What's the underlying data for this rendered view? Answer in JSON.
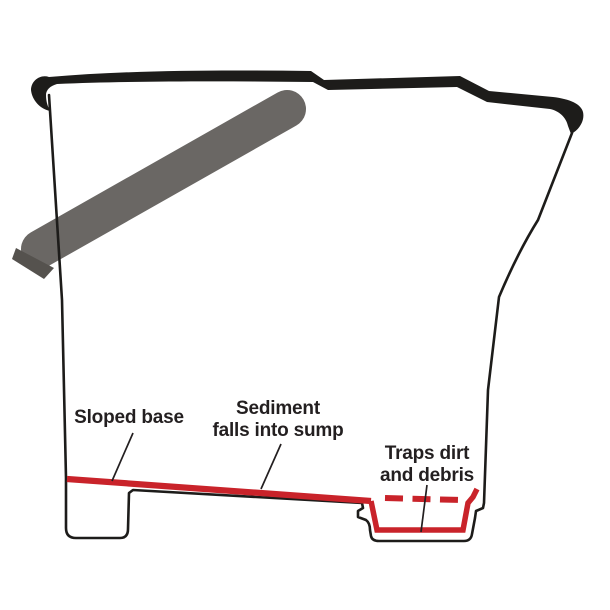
{
  "diagram": {
    "background_color": "#ffffff",
    "colors": {
      "outline_black": "#1d1c1a",
      "accent_red": "#c9232a",
      "handle_gray": "#6a6764",
      "handle_shade": "#55524e",
      "label_text": "#231f20"
    },
    "labels": {
      "sloped_base": {
        "text": "Sloped base"
      },
      "sediment": {
        "line1": "Sediment",
        "line2": "falls into sump"
      },
      "traps": {
        "line1": "Traps dirt",
        "line2": "and debris"
      }
    }
  }
}
